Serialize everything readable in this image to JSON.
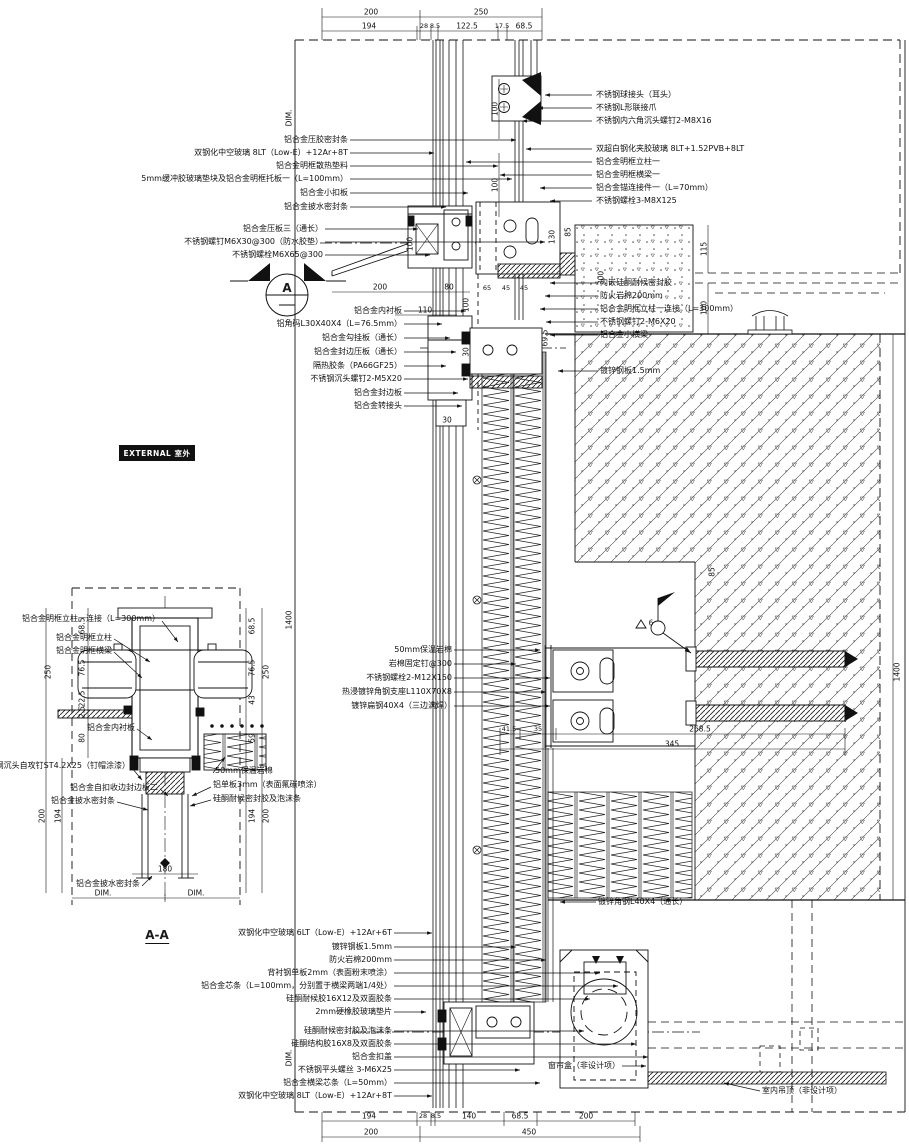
{
  "meta": {
    "badge_external": "EXTERNAL 室外",
    "section_title": "A-A",
    "marker_letter": "A"
  },
  "labels": {
    "tl1": "铝合金压胶密封条",
    "tl2": "双钢化中空玻璃 8LT（Low-E）+12Ar+8T",
    "tl3": "铝合金明框散热垫料",
    "tl4": "5mm缓冲胶玻璃垫块及铝合金明框托板一（L=100mm）",
    "tl5": "铝合金小扣板",
    "tl6": "铝合金披水密封条",
    "tl7": "铝合金压板三（通长）",
    "tl8": "不锈钢螺钉M6X30@300（防水胶垫）",
    "tl9": "不锈钢螺栓M6X65@300",
    "tr1": "不锈钢球接头（耳头）",
    "tr2": "不锈钢L形联接爪",
    "tr3": "不锈钢内六角沉头螺钉2-M8X16",
    "tr4": "双超白钢化夹胶玻璃 8LT+1.52PVB+8LT",
    "tr5": "铝合金明框立柱一",
    "tr6": "铝合金明框横梁一",
    "tr7": "铝合金锚连接件一（L=70mm）",
    "tr8": "不锈钢螺栓3-M8X125",
    "ml1": "铝合金内衬板",
    "ml2": "铝角码L30X40X4（L=76.5mm）",
    "ml3": "铝合金勾挂板（通长）",
    "ml4": "铝合金封边压板（通长）",
    "ml5": "隔热胶条（PA66GF25）",
    "ml6": "不锈钢沉头螺钉2-M5X20",
    "ml7": "铝合金封边板",
    "ml8": "铝合金转接头",
    "c1": "内嵌硅酮耐候密封胶",
    "c2": "防火岩棉200mm",
    "c3": "铝合金明框立柱一连接（L=300mm）",
    "c4": "不锈钢螺钉2-M6X20",
    "c5": "铝合金小横梁",
    "c6": "镀锌钢板1.5mm",
    "mm1": "50mm保温岩棉",
    "mm2": "岩棉固定钉@300",
    "mm3": "不锈钢螺栓2-M12X150",
    "mm4": "热浸镀锌角钢支座L110X70X8",
    "mm5": "镀锌扁钢40X4（三边满焊）",
    "mr1": "镀锌角钢L40X4（通长）",
    "b1": "双钢化中空玻璃 6LT（Low-E）+12Ar+6T",
    "b2": "镀锌钢板1.5mm",
    "b3": "防火岩棉200mm",
    "b4": "背衬钢单板2mm（表面粉末喷涂）",
    "b5": "铝合金芯条（L=100mm，分别置于横梁两端1/4处）",
    "b6": "硅酮耐候胶16X12及双面胶条",
    "b7": "2mm硬橡胶玻璃垫片",
    "b8": "硅酮耐候密封胶及泡沫条",
    "b9": "硅酮结构胶16X8及双面胶条",
    "b10": "铝合金扣盖",
    "b11": "不锈钢平头螺丝 3-M6X25",
    "b12": "铝合金横梁芯条（L=50mm）",
    "b13": "双钢化中空玻璃 8LT（Low-E）+12Ar+8T",
    "br1": "窗帘盒（非设计项）",
    "br2": "室内吊顶（非设计项）",
    "aa1": "铝合金明框立柱一连接（L=300mm）",
    "aa2": "铝合金明框立柱",
    "aa3": "铝合金明框横梁",
    "aa4": "铝合金内衬板",
    "aa5": "不锈钢沉头自攻钉ST4.2X25（钉帽涂漆）",
    "aa6": "铝合金自扣收边封边板二",
    "aa7": "铝合金披水密封条",
    "aa8": "50mm保温岩棉",
    "aa9": "铝单板3mm（表面氟碳喷涂）",
    "aa10": "硅酮耐候密封胶及泡沫条",
    "aa11": "铝合金披水密封条"
  },
  "dims": {
    "DIM": "DIM.",
    "n2_5": "2.5",
    "n6": "6",
    "n8_5": "8.5",
    "n17_5": "17.5",
    "n22_5": "22.5",
    "n28": "28",
    "n30": "30",
    "n35": "35",
    "n41_5": "41.5",
    "n43": "43",
    "n45": "45",
    "n59": "59",
    "n65": "65",
    "n68_5": "68.5",
    "n69_5": "69.5",
    "n76_5": "76.5",
    "n80": "80",
    "n85": "85",
    "n100": "100",
    "n110": "110",
    "n115": "115",
    "n122_5": "122.5",
    "n130": "130",
    "n140": "140",
    "n180": "180",
    "n194": "194",
    "n200": "200",
    "n250": "250",
    "n268_5": "268.5",
    "n300": "300",
    "n345": "345",
    "n450": "450",
    "n1400": "1400"
  }
}
